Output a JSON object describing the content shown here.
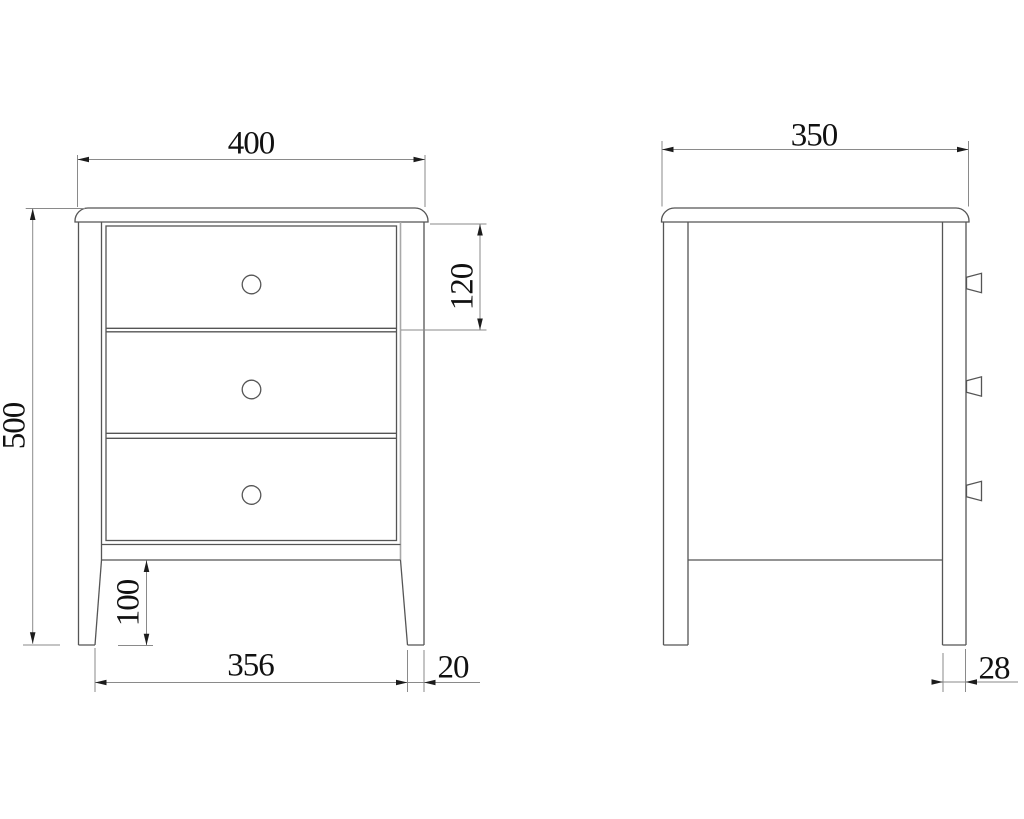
{
  "drawing": {
    "front_view": {
      "drawer_count": 3,
      "dimensions": {
        "overall_width": "400",
        "overall_height": "500",
        "drawer_height": "120",
        "leg_height": "100",
        "leg_inner_span": "356",
        "leg_bottom_width": "20"
      }
    },
    "side_view": {
      "knob_count": 3,
      "dimensions": {
        "overall_depth": "350",
        "leg_depth": "28"
      }
    },
    "colors": {
      "background": "#ffffff",
      "object_line": "#555555",
      "dimension_line": "#8a8a8a",
      "arrow": "#1c1c1c",
      "text": "#111111"
    }
  }
}
